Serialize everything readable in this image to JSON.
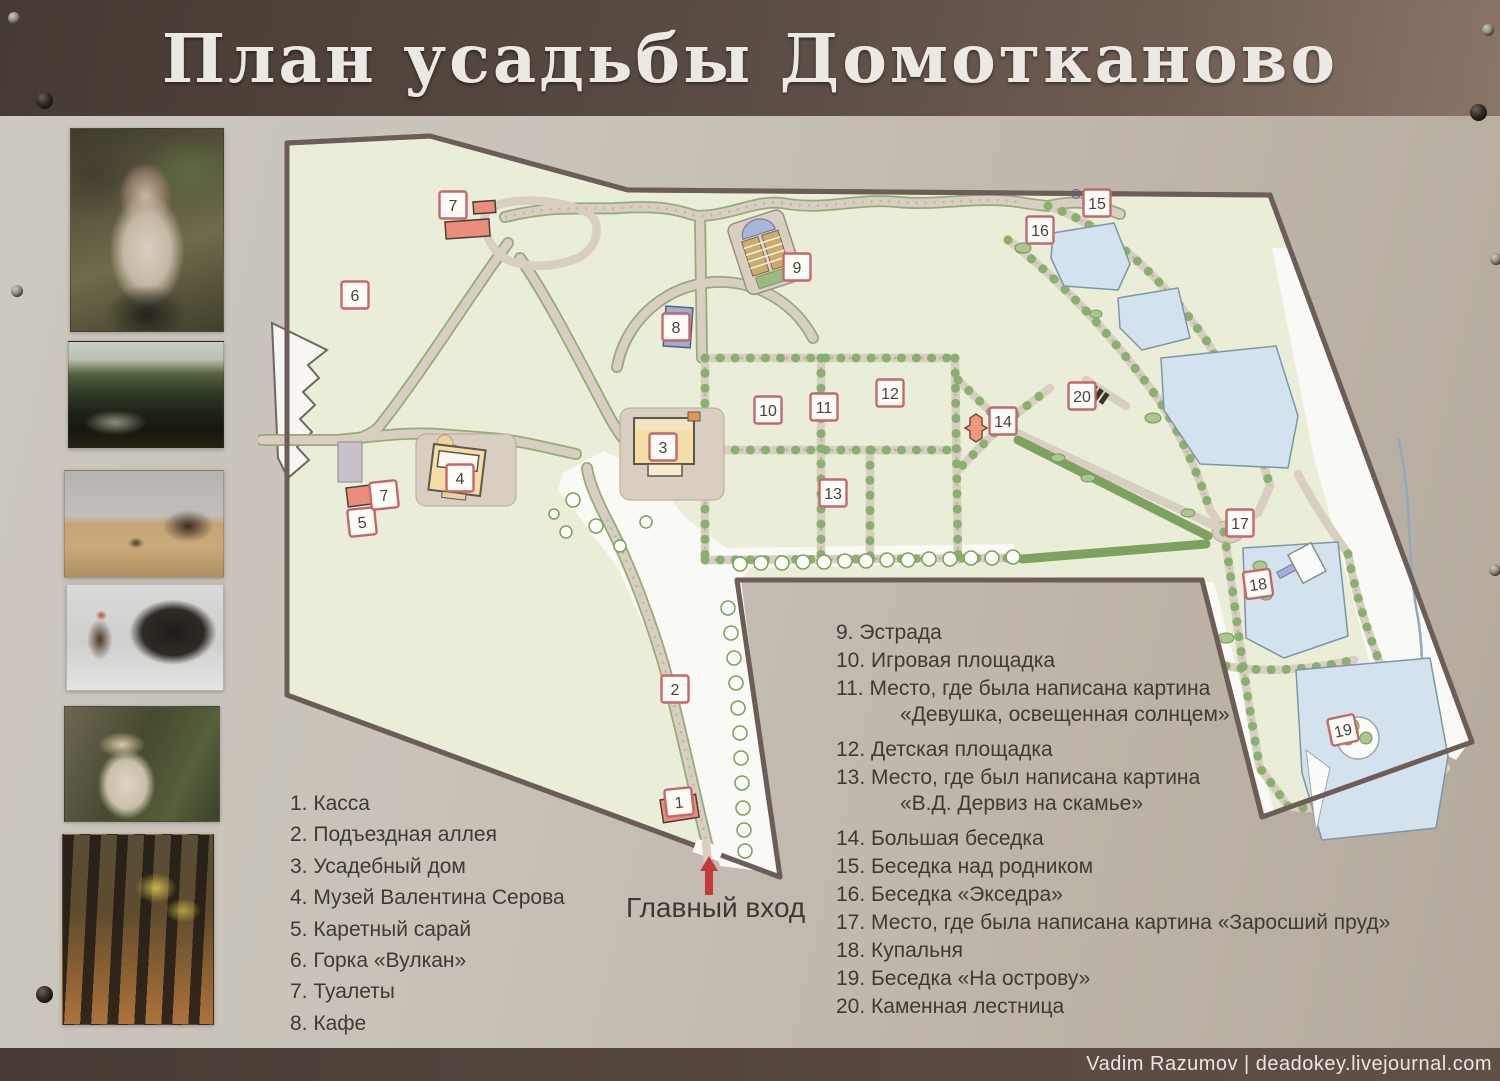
{
  "title": {
    "text": "План усадьбы Домотканово"
  },
  "watermark": {
    "text": "Vadim Razumov | deadokey.livejournal.com"
  },
  "entrance": {
    "label": "Главный вход"
  },
  "legend_left": {
    "items": [
      {
        "num": "1",
        "text": "Касса"
      },
      {
        "num": "2",
        "text": "Подъездная аллея"
      },
      {
        "num": "3",
        "text": "Усадебный дом"
      },
      {
        "num": "4",
        "text": "Музей Валентина Серова"
      },
      {
        "num": "5",
        "text": "Каретный сарай"
      },
      {
        "num": "6",
        "text": "Горка «Вулкан»"
      },
      {
        "num": "7",
        "text": "Туалеты"
      },
      {
        "num": "8",
        "text": "Кафе"
      }
    ]
  },
  "legend_right": {
    "items": [
      {
        "num": "9",
        "text": "Эстрада"
      },
      {
        "num": "10",
        "text": "Игровая площадка"
      },
      {
        "num": "11",
        "text": "Место, где была написана картина",
        "sub": "«Девушка, освещенная солнцем»"
      },
      {
        "num": "12",
        "text": "Детская площадка"
      },
      {
        "num": "13",
        "text": "Место, где был написана картина",
        "sub": "«В.Д. Дервиз на скамье»"
      },
      {
        "num": "14",
        "text": "Большая беседка"
      },
      {
        "num": "15",
        "text": "Беседка над родником"
      },
      {
        "num": "16",
        "text": "Беседка «Экседра»"
      },
      {
        "num": "17",
        "text": "Место, где была написана картина   «Заросший пруд»"
      },
      {
        "num": "18",
        "text": "Купальня"
      },
      {
        "num": "19",
        "text": "Беседка «На острову»"
      },
      {
        "num": "20",
        "text": "Каменная лестница"
      }
    ]
  },
  "map": {
    "markers": [
      {
        "n": "1",
        "x": 421,
        "y": 684,
        "r": -6
      },
      {
        "n": "2",
        "x": 417,
        "y": 571
      },
      {
        "n": "3",
        "x": 405,
        "y": 329
      },
      {
        "n": "4",
        "x": 202,
        "y": 360
      },
      {
        "n": "5",
        "x": 104,
        "y": 404,
        "r": -6
      },
      {
        "n": "6",
        "x": 97,
        "y": 177
      },
      {
        "n": "7",
        "x": 195,
        "y": 87
      },
      {
        "n": "7",
        "x": 126,
        "y": 377,
        "r": -6
      },
      {
        "n": "8",
        "x": 418,
        "y": 209
      },
      {
        "n": "9",
        "x": 539,
        "y": 149
      },
      {
        "n": "10",
        "x": 510,
        "y": 292
      },
      {
        "n": "11",
        "x": 566,
        "y": 289
      },
      {
        "n": "12",
        "x": 632,
        "y": 275
      },
      {
        "n": "13",
        "x": 575,
        "y": 375
      },
      {
        "n": "14",
        "x": 745,
        "y": 303
      },
      {
        "n": "15",
        "x": 839,
        "y": 85
      },
      {
        "n": "16",
        "x": 782,
        "y": 112
      },
      {
        "n": "17",
        "x": 982,
        "y": 405
      },
      {
        "n": "18",
        "x": 1000,
        "y": 466,
        "r": -8
      },
      {
        "n": "19",
        "x": 1085,
        "y": 612,
        "r": -12
      },
      {
        "n": "20",
        "x": 824,
        "y": 278
      }
    ]
  },
  "paintings": {
    "names": [
      "girl-in-sunlight-portrait",
      "overgrown-pond-landscape",
      "field-with-horses",
      "woman-with-horse-in-winter",
      "lady-in-white-hat",
      "autumn-alley"
    ]
  },
  "colors": {
    "banner": "#54473f",
    "board": "#c4bdb3",
    "estate_fill": "#eaedd8",
    "water": "#d3e2ec",
    "frame": "#6d5d58",
    "path": "#d8cfc2",
    "tree": "#86ae6c",
    "marker_border": "#c4686c",
    "red_building": "#ea8d7c",
    "yellow_building": "#f4dda6",
    "blue_building": "#9fadd3",
    "entrance_arrow": "#c13a3c"
  }
}
